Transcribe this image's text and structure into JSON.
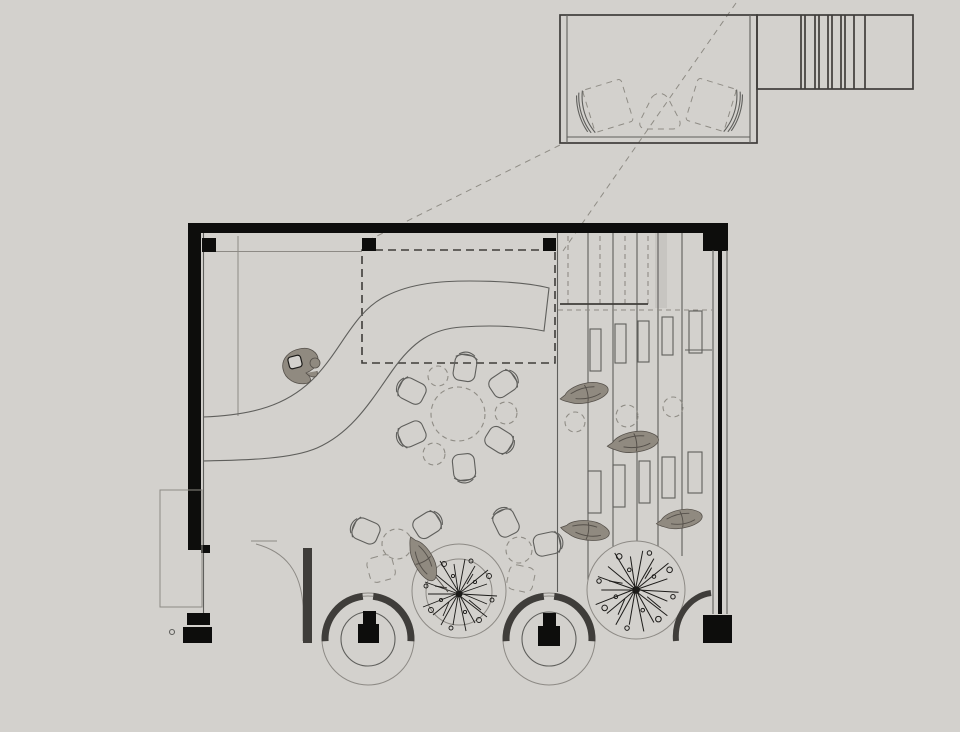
{
  "meta": {
    "drawing_type": "architectural floor plan",
    "view": "top-down plan of a cafe / lounge level with detached mezzanine-room detail and stair at top right",
    "visible_text": ""
  },
  "colors": {
    "paper": "#d3d1cd",
    "ink": "#0d0d0c",
    "line-dark": "#3f3d3a",
    "line-mid": "#5f5f5c",
    "line-light": "#8d8a85",
    "dash": "#8f8c85",
    "blob": "#908a80",
    "blob-edge": "#55504a",
    "tree": "#1c1b19"
  },
  "plan": {
    "upper_room": {
      "name": "detail room with stair",
      "furniture": [
        "lounge-chair",
        "lounge-chair",
        "triangle-table"
      ],
      "stair_treads": 6
    },
    "main_room": {
      "name": "main hall",
      "features": [
        "s-curved bar counter",
        "dashed mezzanine outline",
        "banquette rows (5 columns, 10 seat backs)",
        "round dashed table with 6 tub chairs and 3 stools",
        "lower seating group with 4 tub chairs, 2 dashed stools, 2 dashed chairs",
        "2 planter circles with sketched trees",
        "2 circular hearths with black stoves and thick shell arcs",
        "curved partition walls at both lower corners",
        "5 organic plant sculptures",
        "1 sculptural seat near bar"
      ],
      "columns": 3
    },
    "projection_lines": 2
  }
}
